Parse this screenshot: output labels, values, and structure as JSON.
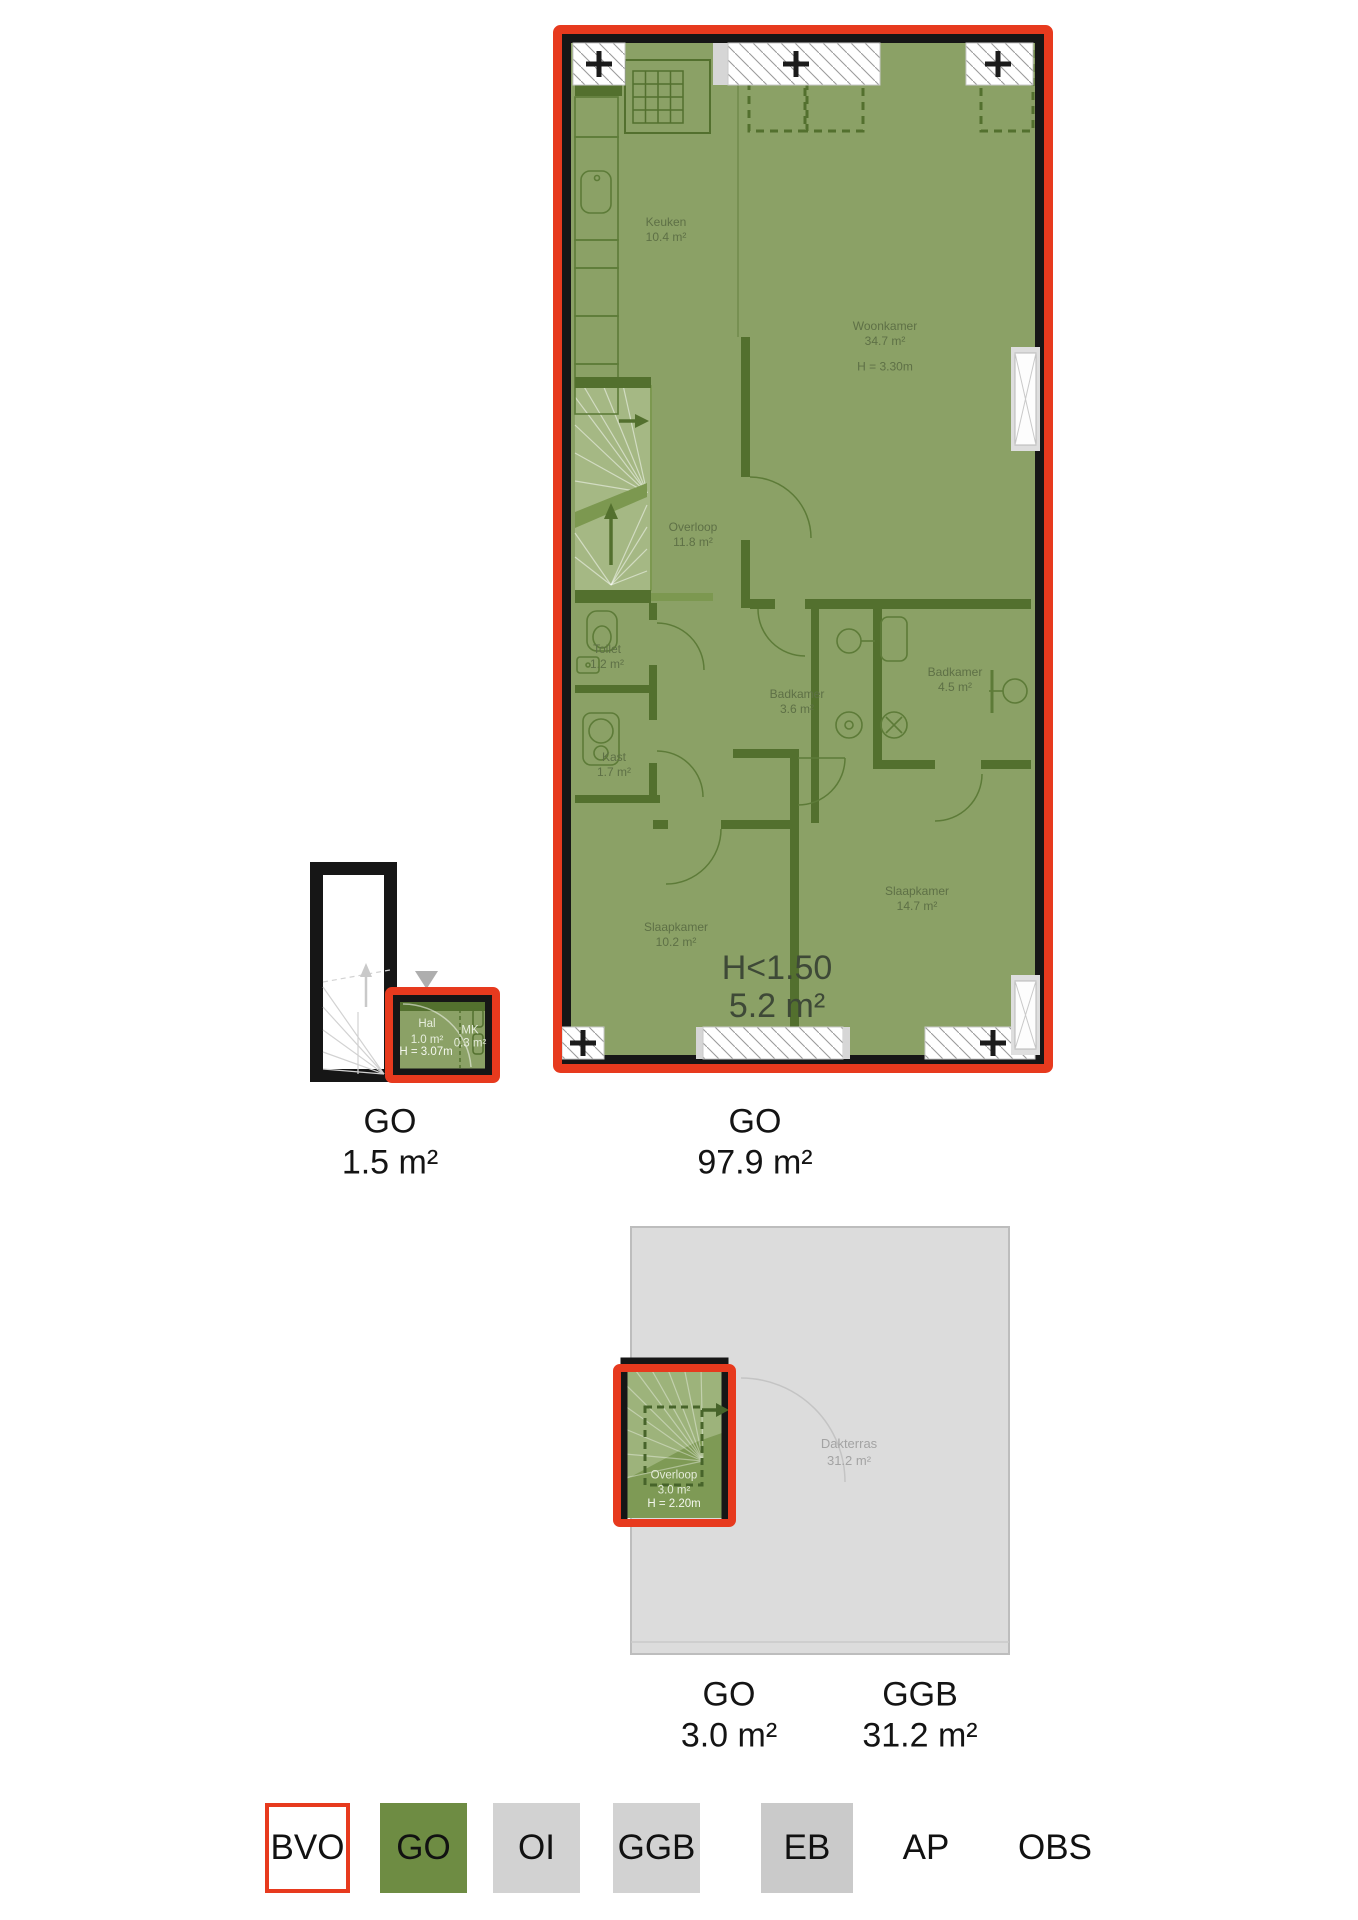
{
  "plan_floor": {
    "rooms": {
      "keuken": {
        "name": "Keuken",
        "area": "10.4 m²"
      },
      "woonkamer": {
        "name": "Woonkamer",
        "area": "34.7 m²",
        "height": "H = 3.30m"
      },
      "overloop": {
        "name": "Overloop",
        "area": "11.8 m²"
      },
      "toilet": {
        "name": "Toilet",
        "area": "1.2 m²"
      },
      "badkamer_klein": {
        "name": "Badkamer",
        "area": "3.6 m²"
      },
      "badkamer_groot": {
        "name": "Badkamer",
        "area": "4.5 m²"
      },
      "kast": {
        "name": "Kast",
        "area": "1.7 m²"
      },
      "slaapkamer_links": {
        "name": "Slaapkamer",
        "area": "10.2 m²"
      },
      "slaapkamer_rechts": {
        "name": "Slaapkamer",
        "area": "14.7 m²"
      },
      "laag": {
        "name": "H<1.50",
        "area": "5.2 m²"
      }
    },
    "caption": {
      "label": "GO",
      "area": "97.9 m²"
    }
  },
  "plan_hal": {
    "rooms": {
      "hal": {
        "name": "Hal",
        "area": "1.0 m²",
        "height": "H = 3.07m"
      },
      "meterkast": {
        "name": "MK",
        "area": "0.3 m²"
      }
    },
    "caption": {
      "label": "GO",
      "area": "1.5 m²"
    }
  },
  "plan_dak": {
    "rooms": {
      "overloop": {
        "name": "Overloop",
        "area": "3.0 m²",
        "height": "H = 2.20m"
      },
      "dakterras": {
        "name": "Dakterras",
        "area": "31.2 m²"
      }
    },
    "captions": {
      "go": {
        "label": "GO",
        "area": "3.0 m²"
      },
      "ggb": {
        "label": "GGB",
        "area": "31.2 m²"
      }
    }
  },
  "legend": {
    "items": [
      {
        "label": "BVO"
      },
      {
        "label": "GO"
      },
      {
        "label": "OI"
      },
      {
        "label": "GGB"
      },
      {
        "label": "EB"
      },
      {
        "label": "AP"
      },
      {
        "label": "OBS"
      }
    ]
  },
  "colors": {
    "bvo_red": "#e73a1e",
    "go_green": "#6e8c43",
    "plan_green": "#8ba166",
    "wall_dark_green": "#53702e",
    "wall_black": "#161616",
    "neutral_gray": "#d2d2d2",
    "eb_gray": "#cacaca",
    "terrace_gray": "#dcdcdc"
  }
}
